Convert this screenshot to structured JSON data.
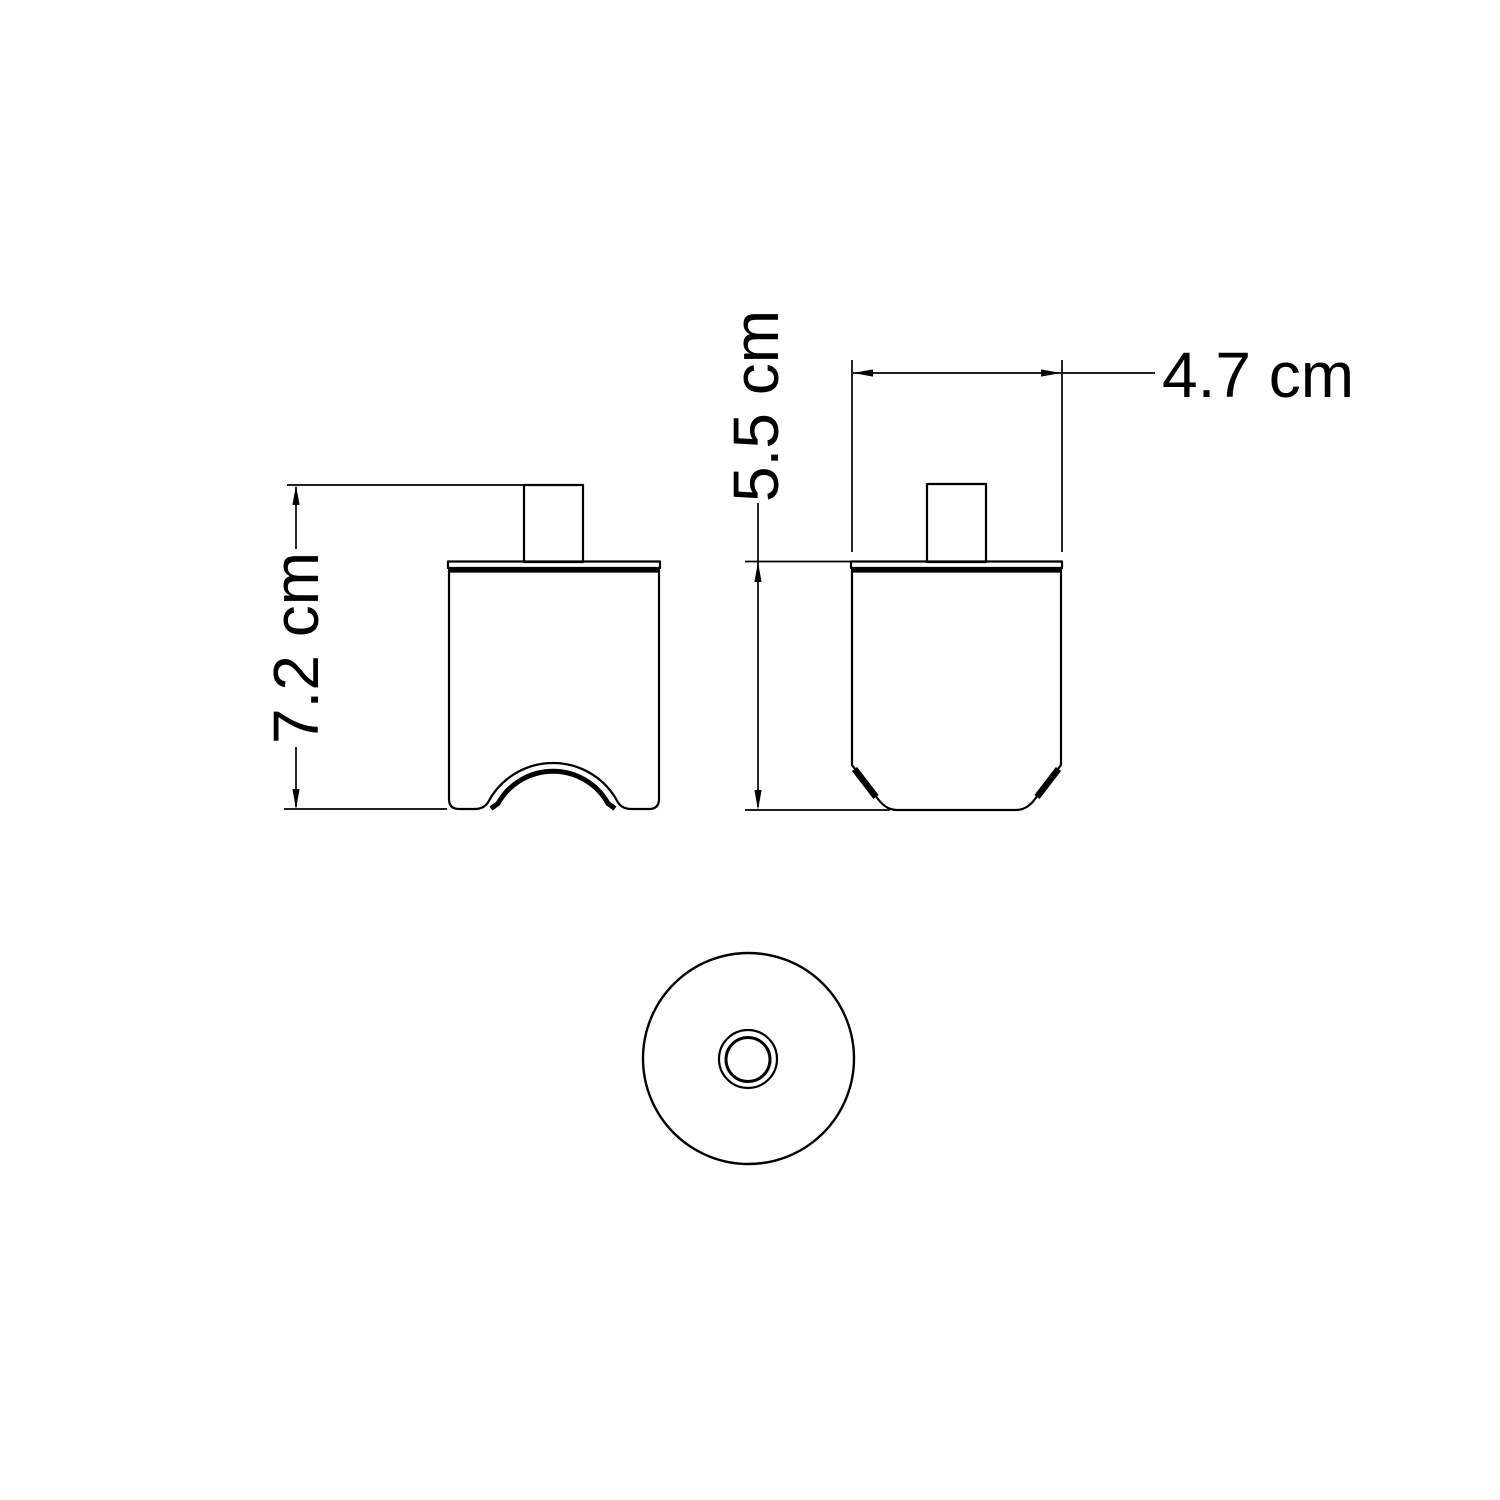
{
  "drawing": {
    "dimensions": {
      "front_height": "7.2 cm",
      "side_height": "5.5 cm",
      "side_width": "4.7 cm"
    },
    "colors": {
      "line": "#000000",
      "background": "#ffffff"
    }
  }
}
